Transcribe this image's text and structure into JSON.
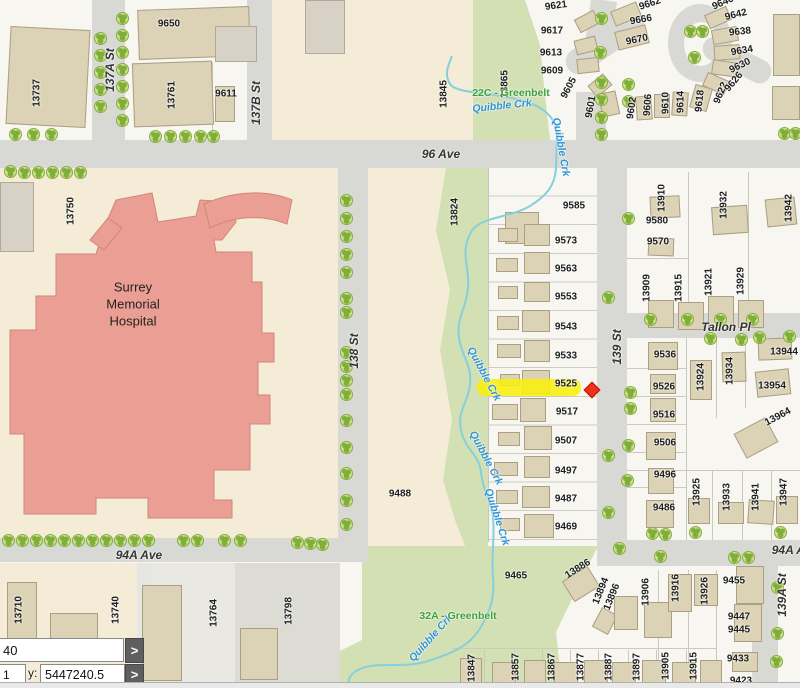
{
  "map": {
    "street_labels": [
      {
        "t": "137A St",
        "x": 110,
        "y": 70,
        "r": -90
      },
      {
        "t": "137B St",
        "x": 256,
        "y": 103,
        "r": -90
      },
      {
        "t": "96 Ave",
        "x": 441,
        "y": 154,
        "r": 0
      },
      {
        "t": "138 St",
        "x": 354,
        "y": 351,
        "r": -90
      },
      {
        "t": "139 St",
        "x": 617,
        "y": 347,
        "r": -90
      },
      {
        "t": "Tallon Pl",
        "x": 726,
        "y": 327,
        "r": 0
      },
      {
        "t": "94A Ave",
        "x": 139,
        "y": 555,
        "r": 0
      },
      {
        "t": "94A Ave",
        "x": 795,
        "y": 550,
        "r": 0
      },
      {
        "t": "139A St",
        "x": 782,
        "y": 595,
        "r": -90
      }
    ],
    "creek_labels": [
      {
        "t": "Quibble Crk",
        "x": 502,
        "y": 106,
        "r": -6
      },
      {
        "t": "Quibble Crk",
        "x": 561,
        "y": 147,
        "r": 80
      },
      {
        "t": "Quibble Crk",
        "x": 484,
        "y": 374,
        "r": 62
      },
      {
        "t": "Quibble Crk",
        "x": 486,
        "y": 458,
        "r": 62
      },
      {
        "t": "Quibble Crk",
        "x": 497,
        "y": 517,
        "r": 72
      },
      {
        "t": "Quibble Crk",
        "x": 431,
        "y": 638,
        "r": -48
      }
    ],
    "greenbelt_labels": [
      {
        "t": "22C - Greenbelt",
        "x": 511,
        "y": 93,
        "r": 0
      },
      {
        "t": "32A - Greenbelt",
        "x": 458,
        "y": 616,
        "r": 0
      }
    ],
    "hospital_label": {
      "lines": [
        "Surrey",
        "Memorial",
        "Hospital"
      ],
      "x": 133,
      "y": 305
    },
    "lot_labels": [
      {
        "t": "9650",
        "x": 169,
        "y": 24,
        "r": 0
      },
      {
        "t": "13737",
        "x": 37,
        "y": 93,
        "r": -90
      },
      {
        "t": "13761",
        "x": 172,
        "y": 95,
        "r": -90
      },
      {
        "t": "9611",
        "x": 226,
        "y": 94,
        "r": 0
      },
      {
        "t": "13845",
        "x": 444,
        "y": 94,
        "r": -90
      },
      {
        "t": "13865",
        "x": 505,
        "y": 84,
        "r": -90
      },
      {
        "t": "9621",
        "x": 556,
        "y": 6,
        "r": -8
      },
      {
        "t": "9617",
        "x": 552,
        "y": 31,
        "r": 0
      },
      {
        "t": "9613",
        "x": 551,
        "y": 53,
        "r": 0
      },
      {
        "t": "9609",
        "x": 552,
        "y": 71,
        "r": 0
      },
      {
        "t": "9605",
        "x": 569,
        "y": 88,
        "r": -62
      },
      {
        "t": "9601",
        "x": 591,
        "y": 107,
        "r": -80
      },
      {
        "t": "9662",
        "x": 650,
        "y": 4,
        "r": -18
      },
      {
        "t": "9666",
        "x": 641,
        "y": 20,
        "r": -10
      },
      {
        "t": "9670",
        "x": 637,
        "y": 40,
        "r": -12
      },
      {
        "t": "9602",
        "x": 632,
        "y": 108,
        "r": -82
      },
      {
        "t": "9606",
        "x": 648,
        "y": 105,
        "r": -86
      },
      {
        "t": "9610",
        "x": 666,
        "y": 103,
        "r": -90
      },
      {
        "t": "9614",
        "x": 681,
        "y": 102,
        "r": -90
      },
      {
        "t": "9618",
        "x": 700,
        "y": 101,
        "r": -84
      },
      {
        "t": "9622",
        "x": 721,
        "y": 93,
        "r": -68
      },
      {
        "t": "9626",
        "x": 734,
        "y": 82,
        "r": -50
      },
      {
        "t": "9630",
        "x": 740,
        "y": 66,
        "r": -26
      },
      {
        "t": "9634",
        "x": 742,
        "y": 51,
        "r": -10
      },
      {
        "t": "9638",
        "x": 740,
        "y": 32,
        "r": -6
      },
      {
        "t": "9642",
        "x": 736,
        "y": 15,
        "r": -14
      },
      {
        "t": "9646",
        "x": 723,
        "y": 3,
        "r": -24
      },
      {
        "t": "13750",
        "x": 71,
        "y": 211,
        "r": -90
      },
      {
        "t": "13824",
        "x": 455,
        "y": 212,
        "r": -90
      },
      {
        "t": "9585",
        "x": 574,
        "y": 206,
        "r": 0
      },
      {
        "t": "9573",
        "x": 566,
        "y": 241,
        "r": 0
      },
      {
        "t": "9563",
        "x": 566,
        "y": 269,
        "r": 0
      },
      {
        "t": "9553",
        "x": 566,
        "y": 297,
        "r": 0
      },
      {
        "t": "9543",
        "x": 566,
        "y": 327,
        "r": 0
      },
      {
        "t": "9533",
        "x": 566,
        "y": 356,
        "r": 0
      },
      {
        "t": "9525",
        "x": 566,
        "y": 384,
        "r": 0
      },
      {
        "t": "9517",
        "x": 567,
        "y": 412,
        "r": 0
      },
      {
        "t": "9507",
        "x": 566,
        "y": 441,
        "r": 0
      },
      {
        "t": "9497",
        "x": 566,
        "y": 471,
        "r": 0
      },
      {
        "t": "9487",
        "x": 566,
        "y": 499,
        "r": 0
      },
      {
        "t": "9469",
        "x": 566,
        "y": 527,
        "r": 0
      },
      {
        "t": "9488",
        "x": 400,
        "y": 494,
        "r": 0
      },
      {
        "t": "13910",
        "x": 662,
        "y": 198,
        "r": -90
      },
      {
        "t": "13932",
        "x": 724,
        "y": 205,
        "r": -90
      },
      {
        "t": "13942",
        "x": 789,
        "y": 208,
        "r": -90
      },
      {
        "t": "9580",
        "x": 657,
        "y": 221,
        "r": 0
      },
      {
        "t": "9570",
        "x": 658,
        "y": 242,
        "r": 0
      },
      {
        "t": "13909",
        "x": 647,
        "y": 288,
        "r": -90
      },
      {
        "t": "13915",
        "x": 679,
        "y": 288,
        "r": -90
      },
      {
        "t": "13921",
        "x": 709,
        "y": 282,
        "r": -90
      },
      {
        "t": "13929",
        "x": 741,
        "y": 281,
        "r": -90
      },
      {
        "t": "9536",
        "x": 665,
        "y": 355,
        "r": 0
      },
      {
        "t": "9526",
        "x": 664,
        "y": 387,
        "r": 0
      },
      {
        "t": "9516",
        "x": 664,
        "y": 415,
        "r": 0
      },
      {
        "t": "9506",
        "x": 665,
        "y": 443,
        "r": 0
      },
      {
        "t": "9496",
        "x": 665,
        "y": 475,
        "r": 0
      },
      {
        "t": "9486",
        "x": 664,
        "y": 508,
        "r": 0
      },
      {
        "t": "13924",
        "x": 701,
        "y": 377,
        "r": -90
      },
      {
        "t": "13934",
        "x": 730,
        "y": 371,
        "r": -90
      },
      {
        "t": "13944",
        "x": 784,
        "y": 352,
        "r": 0
      },
      {
        "t": "13954",
        "x": 772,
        "y": 386,
        "r": 0
      },
      {
        "t": "13964",
        "x": 778,
        "y": 417,
        "r": -28
      },
      {
        "t": "13925",
        "x": 697,
        "y": 492,
        "r": -90
      },
      {
        "t": "13933",
        "x": 727,
        "y": 497,
        "r": -90
      },
      {
        "t": "13941",
        "x": 756,
        "y": 497,
        "r": -90
      },
      {
        "t": "13947",
        "x": 784,
        "y": 492,
        "r": -90
      },
      {
        "t": "13710",
        "x": 19,
        "y": 610,
        "r": -90
      },
      {
        "t": "13740",
        "x": 116,
        "y": 610,
        "r": -90
      },
      {
        "t": "13764",
        "x": 214,
        "y": 613,
        "r": -90
      },
      {
        "t": "13798",
        "x": 289,
        "y": 611,
        "r": -90
      },
      {
        "t": "9465",
        "x": 516,
        "y": 576,
        "r": 0
      },
      {
        "t": "13886",
        "x": 578,
        "y": 569,
        "r": -32
      },
      {
        "t": "13894",
        "x": 601,
        "y": 591,
        "r": -68
      },
      {
        "t": "13896",
        "x": 612,
        "y": 597,
        "r": -68
      },
      {
        "t": "13847",
        "x": 472,
        "y": 668,
        "r": -90
      },
      {
        "t": "13857",
        "x": 516,
        "y": 667,
        "r": -90
      },
      {
        "t": "13867",
        "x": 552,
        "y": 667,
        "r": -90
      },
      {
        "t": "13877",
        "x": 581,
        "y": 667,
        "r": -90
      },
      {
        "t": "13887",
        "x": 609,
        "y": 667,
        "r": -90
      },
      {
        "t": "13897",
        "x": 637,
        "y": 667,
        "r": -90
      },
      {
        "t": "13905",
        "x": 666,
        "y": 666,
        "r": -90
      },
      {
        "t": "13915",
        "x": 694,
        "y": 666,
        "r": -90
      },
      {
        "t": "13906",
        "x": 646,
        "y": 592,
        "r": -90
      },
      {
        "t": "13916",
        "x": 676,
        "y": 588,
        "r": -90
      },
      {
        "t": "13926",
        "x": 705,
        "y": 591,
        "r": -90
      },
      {
        "t": "9455",
        "x": 734,
        "y": 581,
        "r": 0
      },
      {
        "t": "9447",
        "x": 739,
        "y": 617,
        "r": 0
      },
      {
        "t": "9445",
        "x": 739,
        "y": 630,
        "r": 0
      },
      {
        "t": "9433",
        "x": 738,
        "y": 659,
        "r": 0
      },
      {
        "t": "9423",
        "x": 741,
        "y": 681,
        "r": 0
      }
    ],
    "highlight": {
      "parcel": "9525",
      "color": "#f8ef0d",
      "marker_color": "#ee3117"
    },
    "colors": {
      "greenbelt": "#d3e0b4",
      "creek": "#86cfdc",
      "hospital": "#eb9e94",
      "road": "#d8d8d5"
    }
  },
  "coordinate_panel": {
    "x_value_partial": "40",
    "second_value_partial": "1",
    "y_label": "y:",
    "y_value": "5447240.5",
    "go_button_label": ">"
  }
}
